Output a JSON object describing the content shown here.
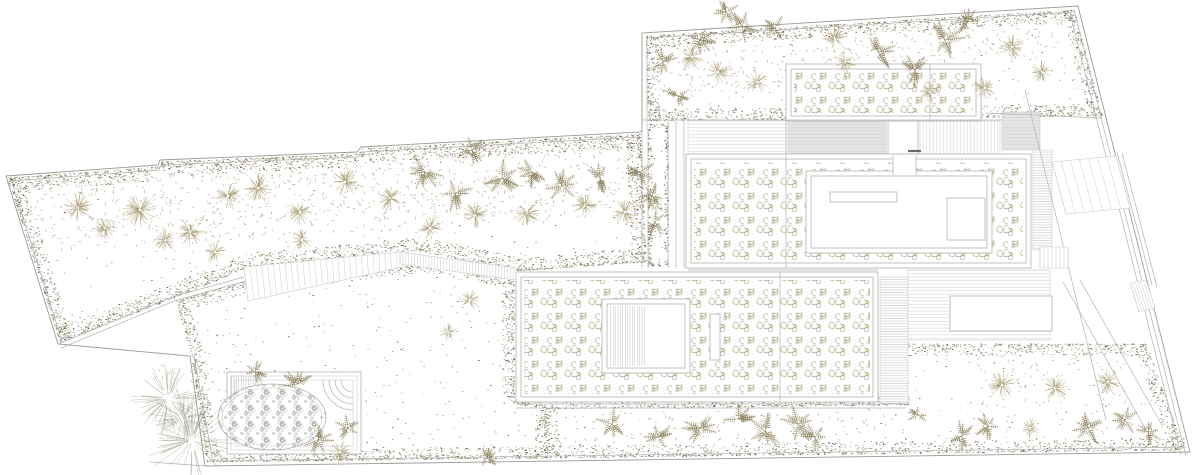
{
  "meta": {
    "width": 1200,
    "height": 475,
    "background": "#ffffff",
    "seed": 12
  },
  "palette": {
    "line": "#b2b2b2",
    "line_soft": "#cdcdcd",
    "line_dark": "#9a9a9a",
    "dark": "#6a6a6a",
    "veg": "#a09467",
    "veg_soft": "#b3aa80",
    "veg_dark": "#857a52",
    "dot_olive": "#8f8560",
    "dot_gray": "#a3a39e",
    "speck": "#5f5a45",
    "pebble": "#a89e76",
    "stone": "#9c9c94",
    "gray_fill": "#e4e4e5",
    "hatch": "#d2d2d2",
    "hatch_dark": "#c4c4c4",
    "white": "#ffffff"
  },
  "boundary": {
    "outer": [
      [
        6,
        176
      ],
      [
        158,
        165
      ],
      [
        160,
        160
      ],
      [
        357,
        152
      ],
      [
        361,
        147
      ],
      [
        640,
        132
      ],
      [
        642,
        131
      ],
      [
        642,
        33
      ],
      [
        1078,
        6
      ],
      [
        1190,
        452
      ],
      [
        205,
        466
      ],
      [
        190,
        356
      ],
      [
        58,
        344
      ]
    ]
  },
  "polylines": [
    {
      "name": "garden-wall",
      "pts": [
        [
          58,
          344
        ],
        [
          172,
          297
        ],
        [
          244,
          277
        ]
      ]
    },
    {
      "name": "garden-wall-inner",
      "pts": [
        [
          61,
          348
        ],
        [
          174,
          301
        ],
        [
          246,
          281
        ]
      ]
    },
    {
      "name": "boundary-inner-top-left",
      "pts": [
        [
          10,
          181
        ],
        [
          159,
          170
        ],
        [
          161,
          165
        ],
        [
          358,
          157
        ],
        [
          362,
          152
        ],
        [
          638,
          137
        ]
      ]
    },
    {
      "name": "boundary-inner-top-right",
      "pts": [
        [
          647,
          131
        ],
        [
          647,
          38
        ],
        [
          1073,
          12
        ]
      ]
    },
    {
      "name": "boundary-inner-east",
      "pts": [
        [
          1074,
          10
        ],
        [
          1186,
          456
        ]
      ]
    },
    {
      "name": "boundary-inner-east-2",
      "pts": [
        [
          1070,
          13
        ],
        [
          1181,
          455
        ]
      ]
    },
    {
      "name": "boundary-inner-south",
      "pts": [
        [
          208,
          461
        ],
        [
          1186,
          447
        ]
      ]
    },
    {
      "name": "boundary-inner-west",
      "pts": [
        [
          11,
          180
        ],
        [
          62,
          341
        ]
      ]
    },
    {
      "name": "lower-garden-west-edge",
      "pts": [
        [
          194,
          356
        ],
        [
          213,
          462
        ]
      ]
    }
  ],
  "gardens": [
    {
      "name": "left-garden",
      "layer": 1,
      "points": [
        [
          8,
          178
        ],
        [
          159,
          167
        ],
        [
          161,
          162
        ],
        [
          358,
          154
        ],
        [
          362,
          149
        ],
        [
          640,
          134
        ],
        [
          646,
          262
        ],
        [
          518,
          271
        ],
        [
          420,
          251
        ],
        [
          246,
          268
        ],
        [
          174,
          298
        ],
        [
          60,
          342
        ]
      ],
      "base": 0.003,
      "edge_width": 14,
      "edge_density": 2.4
    },
    {
      "name": "lower-left-garden",
      "layer": 1,
      "points": [
        [
          176,
          301
        ],
        [
          246,
          281
        ],
        [
          420,
          261
        ],
        [
          514,
          276
        ],
        [
          514,
          404
        ],
        [
          545,
          408
        ],
        [
          548,
          458
        ],
        [
          207,
          462
        ],
        [
          192,
          357
        ]
      ],
      "base": 0.005,
      "edge_width": 12,
      "edge_density": 2.0
    },
    {
      "name": "upper-right-garden",
      "layer": 1,
      "points": [
        [
          646,
          36
        ],
        [
          1074,
          10
        ],
        [
          1102,
          116
        ],
        [
          648,
          121
        ]
      ],
      "base": 0.005,
      "edge_width": 12,
      "edge_density": 2.0
    },
    {
      "name": "left-planting-strip",
      "layer": 1,
      "points": [
        [
          648,
          124
        ],
        [
          668,
          124
        ],
        [
          668,
          266
        ],
        [
          648,
          266
        ]
      ],
      "base": 0.012,
      "edge_width": 4,
      "edge_density": 1.0
    },
    {
      "name": "bottom-garden",
      "layer": 1,
      "points": [
        [
          545,
          409
        ],
        [
          908,
          405
        ],
        [
          908,
          344
        ],
        [
          1146,
          344
        ],
        [
          1184,
          450
        ],
        [
          550,
          458
        ]
      ],
      "base": 0.005,
      "edge_width": 12,
      "edge_density": 1.7
    },
    {
      "name": "courtyard-roof-garden",
      "layer": 2,
      "points": [
        [
          814,
          179
        ],
        [
          984,
          179
        ],
        [
          984,
          245
        ],
        [
          814,
          245
        ]
      ],
      "base": 0.007,
      "edge_width": 8,
      "edge_density": 0.8
    }
  ],
  "scrub": [
    {
      "name": "left-garden-scrub",
      "points": [
        [
          10,
          180
        ],
        [
          160,
          168
        ],
        [
          358,
          155
        ],
        [
          638,
          136
        ],
        [
          644,
          210
        ],
        [
          540,
          222
        ],
        [
          420,
          230
        ],
        [
          300,
          236
        ],
        [
          150,
          246
        ],
        [
          62,
          250
        ]
      ],
      "density": 0.016
    },
    {
      "name": "upper-right-scrub",
      "points": [
        [
          648,
          38
        ],
        [
          1072,
          12
        ],
        [
          1080,
          44
        ],
        [
          950,
          68
        ],
        [
          800,
          86
        ],
        [
          700,
          94
        ],
        [
          650,
          96
        ]
      ],
      "density": 0.013
    },
    {
      "name": "bottom-band-scrub",
      "points": [
        [
          565,
          412
        ],
        [
          895,
          408
        ],
        [
          895,
          432
        ],
        [
          565,
          446
        ]
      ],
      "density": 0.007
    },
    {
      "name": "bottom-right-scrub",
      "points": [
        [
          950,
          350
        ],
        [
          1138,
          350
        ],
        [
          1158,
          415
        ],
        [
          1000,
          400
        ]
      ],
      "density": 0.006
    },
    {
      "name": "pond-scrub",
      "points": [
        [
          150,
          365
        ],
        [
          230,
          358
        ],
        [
          265,
          362
        ],
        [
          258,
          400
        ],
        [
          170,
          408
        ]
      ],
      "density": 0.009
    }
  ],
  "terraces": [
    {
      "name": "upper-terrace-deck",
      "x": 688,
      "y": 120,
      "w": 98,
      "h": 34,
      "fill": "hatchH",
      "stroke": "soft"
    },
    {
      "name": "upper-terrace-deck-east",
      "x": 920,
      "y": 121,
      "w": 80,
      "h": 33,
      "fill": "hatchV",
      "stroke": "soft"
    },
    {
      "name": "canopy-roof",
      "x": 788,
      "y": 121,
      "w": 98,
      "h": 33,
      "fill": "grayH",
      "stroke": "soft"
    },
    {
      "name": "utility-roof",
      "x": 1002,
      "y": 112,
      "w": 38,
      "h": 38,
      "fill": "grayH",
      "stroke": "soft"
    },
    {
      "name": "link-corridor",
      "x": 888,
      "y": 121,
      "w": 30,
      "h": 33,
      "fill": "white",
      "stroke": "line"
    },
    {
      "name": "east-walk",
      "x": 1033,
      "y": 150,
      "w": 19,
      "h": 100,
      "fill": "hatchHf",
      "stroke": "soft"
    },
    {
      "name": "side-deck",
      "x": 880,
      "y": 277,
      "w": 28,
      "h": 126,
      "fill": "hatchHf",
      "stroke": "soft"
    },
    {
      "name": "lower-terrace",
      "x": 908,
      "y": 270,
      "w": 142,
      "h": 70,
      "fill": "hatchH",
      "stroke": "soft"
    },
    {
      "name": "terrace-platform",
      "x": 950,
      "y": 296,
      "w": 102,
      "h": 35,
      "fill": "white",
      "stroke": "line"
    }
  ],
  "buildings": [
    {
      "name": "pool-pavilion-roof",
      "x": 786,
      "y": 64,
      "w": 195,
      "h": 57,
      "fill": "white",
      "stroke": "line"
    },
    {
      "name": "pool-pavilion-roof-inner",
      "x": 791,
      "y": 69,
      "w": 185,
      "h": 47,
      "fill": "none",
      "stroke": "line"
    },
    {
      "name": "pool-pavilion-gravel",
      "x": 794,
      "y": 72,
      "w": 179,
      "h": 41,
      "fill": "pebble",
      "stroke": "none"
    },
    {
      "name": "main-house-roof",
      "x": 686,
      "y": 154,
      "w": 345,
      "h": 114,
      "fill": "white",
      "stroke": "line"
    },
    {
      "name": "main-house-roof-inner",
      "x": 691,
      "y": 159,
      "w": 335,
      "h": 104,
      "fill": "none",
      "stroke": "line"
    },
    {
      "name": "main-house-gravel",
      "x": 694,
      "y": 162,
      "w": 329,
      "h": 98,
      "fill": "pebble",
      "stroke": "none"
    },
    {
      "name": "main-house-court",
      "x": 806,
      "y": 171,
      "w": 186,
      "h": 82,
      "fill": "white",
      "stroke": "line"
    },
    {
      "name": "main-house-court-inner",
      "x": 811,
      "y": 176,
      "w": 176,
      "h": 72,
      "fill": "none",
      "stroke": "line"
    },
    {
      "name": "court-skylight",
      "x": 830,
      "y": 192,
      "w": 67,
      "h": 10,
      "fill": "white",
      "stroke": "line"
    },
    {
      "name": "court-roof-hatch",
      "x": 947,
      "y": 198,
      "w": 38,
      "h": 42,
      "fill": "white",
      "stroke": "line"
    },
    {
      "name": "roof-notch",
      "x": 893,
      "y": 155,
      "w": 23,
      "h": 20,
      "fill": "white",
      "stroke": "none"
    },
    {
      "name": "guest-house-roof",
      "x": 516,
      "y": 272,
      "w": 362,
      "h": 130,
      "fill": "white",
      "stroke": "line"
    },
    {
      "name": "guest-house-roof-inner",
      "x": 521,
      "y": 277,
      "w": 352,
      "h": 120,
      "fill": "none",
      "stroke": "line"
    },
    {
      "name": "guest-house-gravel",
      "x": 524,
      "y": 280,
      "w": 346,
      "h": 114,
      "fill": "pebble",
      "stroke": "none"
    },
    {
      "name": "guest-patio",
      "x": 602,
      "y": 299,
      "w": 88,
      "h": 74,
      "fill": "white",
      "stroke": "line"
    },
    {
      "name": "guest-patio-inner",
      "x": 607,
      "y": 304,
      "w": 78,
      "h": 64,
      "fill": "none",
      "stroke": "line"
    },
    {
      "name": "guest-patio-deck",
      "x": 609,
      "y": 306,
      "w": 37,
      "h": 60,
      "fill": "hatchVf",
      "stroke": "none"
    },
    {
      "name": "guest-skylight-slot",
      "x": 710,
      "y": 314,
      "w": 10,
      "h": 46,
      "fill": "white",
      "stroke": "line"
    }
  ],
  "lines": [
    [
      642,
      131,
      642,
      268
    ],
    [
      648,
      131,
      648,
      268
    ],
    [
      668,
      121,
      668,
      268
    ],
    [
      676,
      121,
      676,
      268
    ],
    [
      684,
      121,
      684,
      268
    ],
    [
      642,
      120,
      1002,
      120
    ],
    [
      985,
      113,
      1102,
      118
    ],
    [
      786,
      121,
      786,
      268
    ],
    [
      930,
      64,
      930,
      121
    ],
    [
      780,
      272,
      780,
      402
    ],
    [
      893,
      155,
      893,
      175
    ],
    [
      916,
      155,
      916,
      175
    ],
    [
      908,
      151,
      921,
      151,
      "dark",
      2.2
    ],
    [
      516,
      404,
      906,
      404
    ],
    [
      516,
      408,
      906,
      408
    ],
    [
      688,
      270,
      878,
      270
    ],
    [
      1025,
      90,
      1106,
      420
    ],
    [
      1080,
      280,
      1163,
      427
    ],
    [
      1063,
      282,
      1146,
      430
    ],
    [
      1117,
      152,
      1152,
      285
    ],
    [
      1122,
      153,
      1157,
      287
    ],
    [
      150,
      462,
      206,
      466
    ]
  ],
  "stairs": [
    {
      "name": "garden-steps",
      "a": [
        [
          244,
          267
        ],
        [
          420,
          250
        ]
      ],
      "b": [
        [
          248,
          301
        ],
        [
          420,
          263
        ]
      ],
      "n": 30
    },
    {
      "name": "garden-steps-fine",
      "a": [
        [
          400,
          252
        ],
        [
          516,
          268
        ]
      ],
      "b": [
        [
          400,
          264
        ],
        [
          516,
          280
        ]
      ],
      "n": 40
    },
    {
      "name": "drive-steps",
      "a": [
        [
          1052,
          162
        ],
        [
          1116,
          156
        ]
      ],
      "b": [
        [
          1066,
          214
        ],
        [
          1130,
          208
        ]
      ],
      "n": 7
    },
    {
      "name": "side-steps",
      "a": [
        [
          1040,
          247
        ],
        [
          1068,
          247
        ]
      ],
      "b": [
        [
          1040,
          268
        ],
        [
          1068,
          268
        ]
      ],
      "n": 7
    },
    {
      "name": "gate-steps",
      "a": [
        [
          1130,
          283
        ],
        [
          1146,
          280
        ]
      ],
      "b": [
        [
          1139,
          312
        ],
        [
          1155,
          308
        ]
      ],
      "n": 6
    }
  ],
  "pond": {
    "frames": [
      [
        227,
        372,
        134,
        82
      ],
      [
        231,
        376,
        126,
        74
      ],
      [
        235,
        380,
        118,
        66
      ]
    ],
    "hatch_rect": [
      231,
      376,
      31,
      21
    ],
    "steps": {
      "cx": 353,
      "cy": 380,
      "radii": [
        12,
        18,
        24,
        30
      ]
    },
    "basin": {
      "cx": 272,
      "cy": 417,
      "rx": 54,
      "ry": 33
    }
  },
  "trees": {
    "shrubs": [
      [
        78,
        208,
        14
      ],
      [
        105,
        228,
        11
      ],
      [
        140,
        210,
        16
      ],
      [
        190,
        232,
        13
      ],
      [
        228,
        196,
        12
      ],
      [
        258,
        188,
        14
      ],
      [
        300,
        212,
        12
      ],
      [
        345,
        182,
        13
      ],
      [
        390,
        198,
        12
      ],
      [
        302,
        240,
        10
      ],
      [
        430,
        228,
        11
      ],
      [
        475,
        215,
        12
      ],
      [
        527,
        213,
        12
      ],
      [
        585,
        205,
        12
      ],
      [
        625,
        212,
        11
      ],
      [
        215,
        252,
        10
      ],
      [
        165,
        240,
        11
      ],
      [
        692,
        57,
        12
      ],
      [
        718,
        72,
        11
      ],
      [
        757,
        82,
        10
      ],
      [
        835,
        38,
        12
      ],
      [
        845,
        62,
        10
      ],
      [
        985,
        88,
        11
      ],
      [
        1012,
        47,
        12
      ],
      [
        1042,
        72,
        11
      ],
      [
        930,
        92,
        9
      ],
      [
        1002,
        385,
        13
      ],
      [
        1055,
        388,
        12
      ],
      [
        1108,
        382,
        12
      ],
      [
        1030,
        428,
        9
      ],
      [
        470,
        300,
        9
      ],
      [
        448,
        332,
        8
      ],
      [
        340,
        452,
        10
      ],
      [
        655,
        205,
        9
      ]
    ],
    "big_shrubs": [
      [
        168,
        398,
        30
      ],
      [
        192,
        440,
        36
      ],
      [
        183,
        418,
        24
      ]
    ],
    "ferns": [
      [
        700,
        40,
        1
      ],
      [
        742,
        26,
        1.1
      ],
      [
        726,
        12,
        0.8
      ],
      [
        878,
        52,
        1.1
      ],
      [
        915,
        70,
        1
      ],
      [
        945,
        40,
        1.2
      ],
      [
        968,
        22,
        0.8
      ],
      [
        663,
        62,
        0.9
      ],
      [
        678,
        96,
        0.8
      ],
      [
        775,
        28,
        0.9
      ],
      [
        425,
        172,
        1.1
      ],
      [
        455,
        193,
        1
      ],
      [
        472,
        150,
        0.9
      ],
      [
        502,
        178,
        1.2
      ],
      [
        532,
        172,
        1
      ],
      [
        562,
        186,
        1
      ],
      [
        640,
        172,
        0.9
      ],
      [
        652,
        196,
        0.8
      ],
      [
        600,
        178,
        0.9
      ],
      [
        655,
        222,
        0.8
      ],
      [
        298,
        384,
        1
      ],
      [
        318,
        440,
        0.9
      ],
      [
        348,
        428,
        0.8
      ],
      [
        255,
        372,
        0.7
      ],
      [
        612,
        424,
        1
      ],
      [
        658,
        437,
        0.9
      ],
      [
        700,
        428,
        1.1
      ],
      [
        738,
        419,
        1
      ],
      [
        765,
        431,
        1.1
      ],
      [
        798,
        424,
        1.2
      ],
      [
        815,
        437,
        0.9
      ],
      [
        962,
        436,
        0.9
      ],
      [
        988,
        426,
        0.8
      ],
      [
        1088,
        428,
        1
      ],
      [
        1125,
        420,
        0.9
      ],
      [
        1148,
        432,
        0.8
      ],
      [
        487,
        458,
        0.8
      ],
      [
        918,
        415,
        0.7
      ]
    ]
  }
}
